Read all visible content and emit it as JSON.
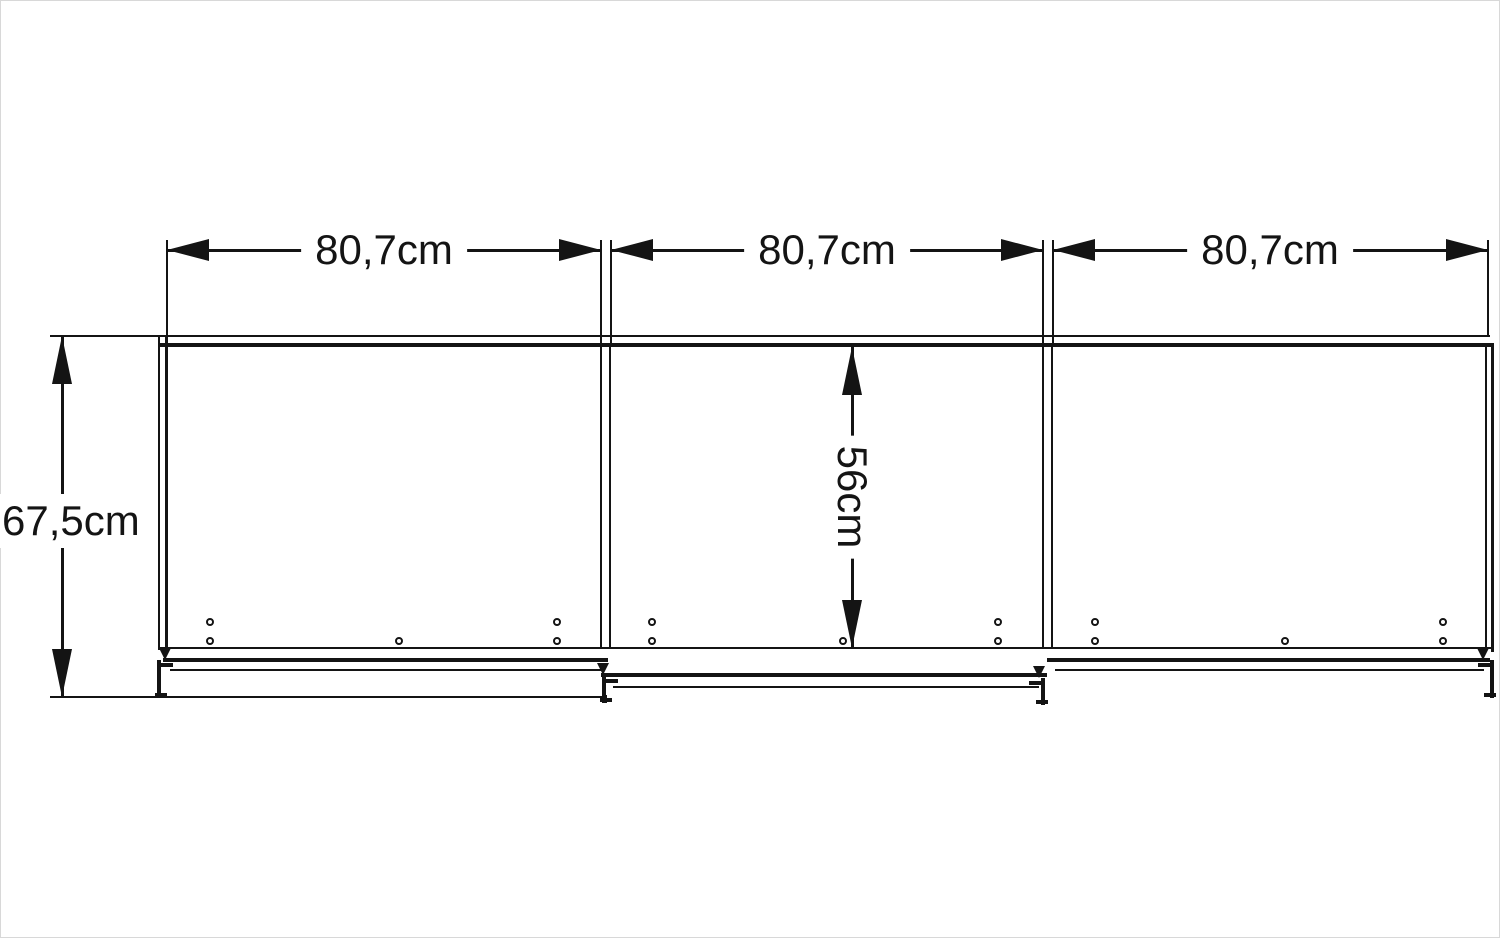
{
  "canvas": {
    "background": "#ffffff",
    "line_color": "#141414",
    "border_color": "#d8d8d8"
  },
  "diagram": {
    "type": "furniture-dimension-drawing",
    "view": "front elevation of three-section sliding-door wardrobe",
    "labels": {
      "width_1": "80,7cm",
      "width_2": "80,7cm",
      "width_3": "80,7cm",
      "height": "67,5cm",
      "inner_height": "56cm"
    }
  }
}
